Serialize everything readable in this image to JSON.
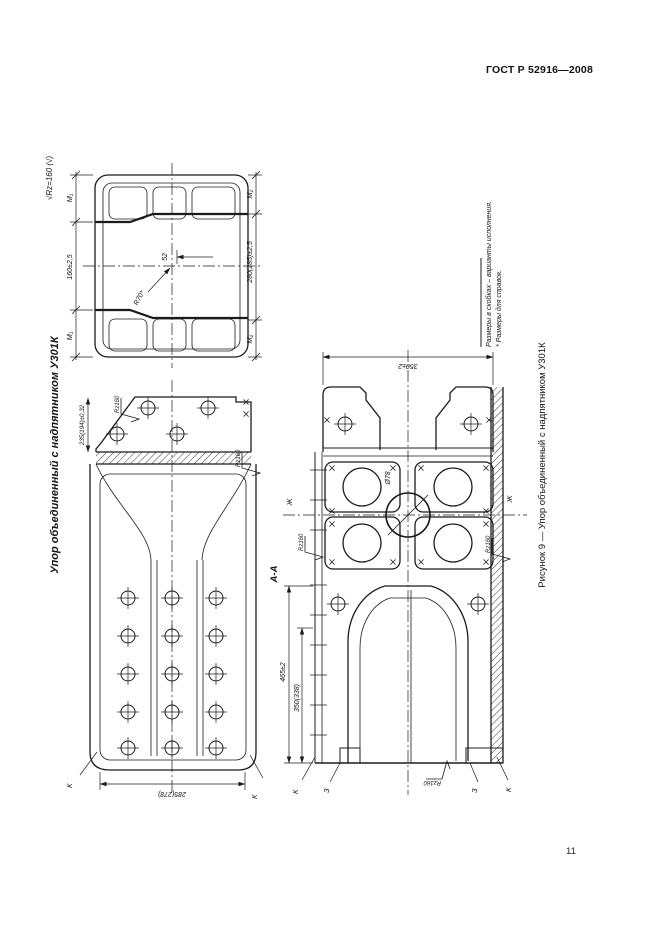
{
  "page": {
    "header": "ГОСТ Р 52916—2008",
    "number": "11"
  },
  "figure": {
    "side_title": "Упор объединенный с надпятником У301К",
    "caption": "Рисунок 9 — Упор объединенный с надпятником У301К",
    "footnote_line1": "* Размеры для справок.",
    "footnote_line2": "Размеры в скобках – варианты исполнения.",
    "roughness_general": "√Rz=160 (√)"
  },
  "plan": {
    "m1": "М₁",
    "m2": "М₂",
    "dim_width": "160±2,5",
    "dim_length": "280(285)±2,5",
    "dim_slot": "52",
    "radius": "R70*"
  },
  "elevation": {
    "dim_top": "235(194)±0,32",
    "dim_base": "285(278)",
    "rz": "Rz160",
    "k": "К"
  },
  "section": {
    "label": "А-А",
    "dim_top": "350±2",
    "dia": "Ø78",
    "dim_h1": "465±2",
    "dim_h2": "350(338)",
    "zh": "Ж",
    "z": "З",
    "k": "К",
    "rz": "Rz160"
  }
}
